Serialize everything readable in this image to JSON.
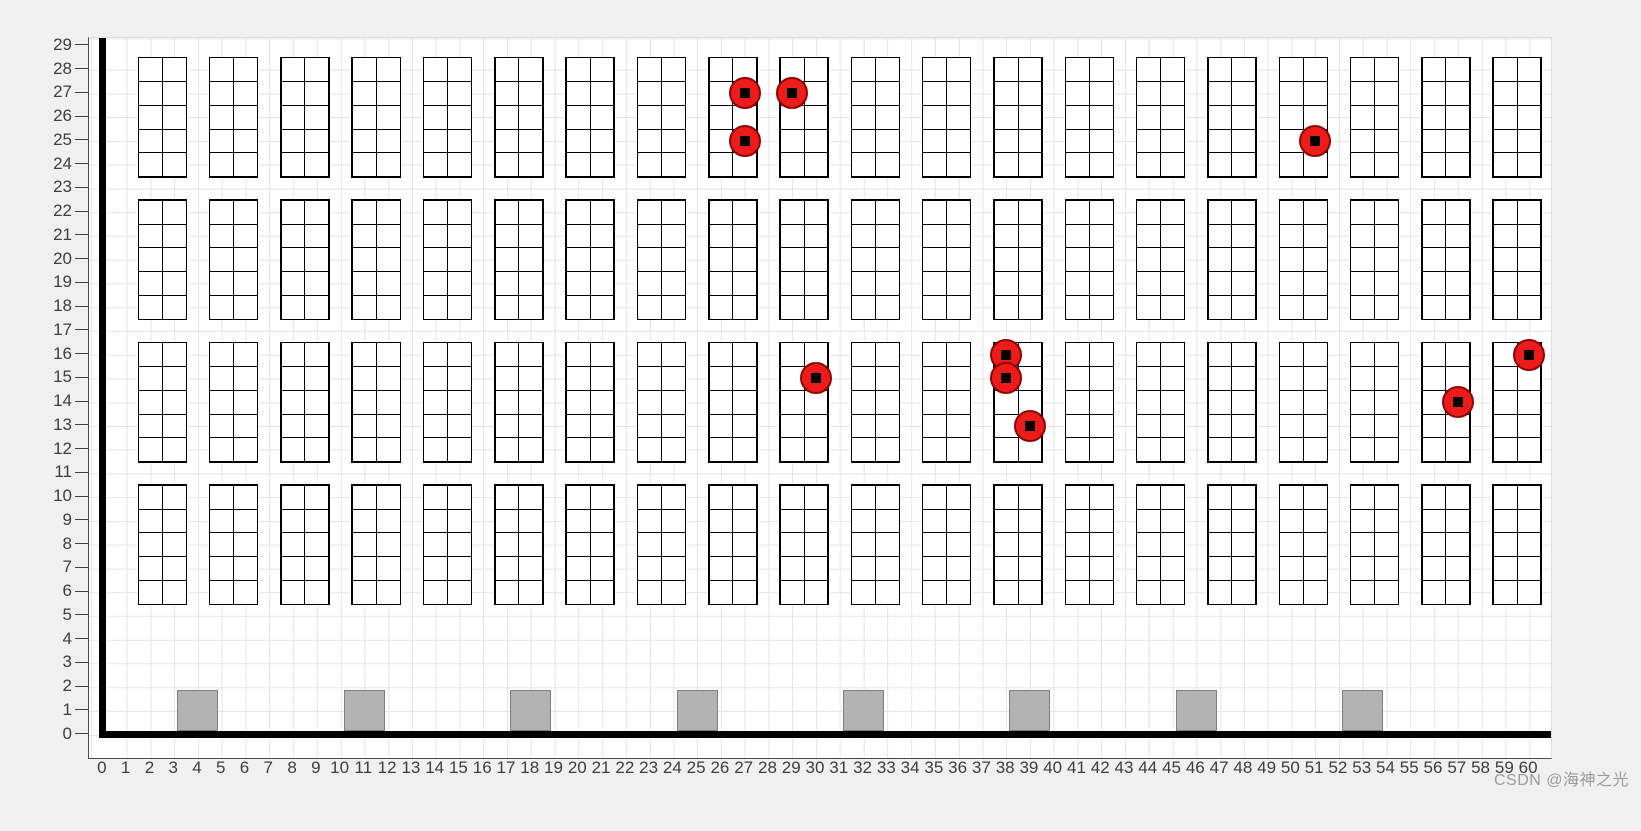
{
  "watermark": {
    "text": "CSDN @海神之光",
    "color": "#9b9b9b"
  },
  "chart_data": {
    "type": "scatter",
    "title": "",
    "xlabel": "",
    "ylabel": "",
    "xlim": [
      -0.6,
      60.9
    ],
    "ylim": [
      -1.0,
      29.3
    ],
    "grid": true,
    "x_ticks": [
      0,
      1,
      2,
      3,
      4,
      5,
      6,
      7,
      8,
      9,
      10,
      11,
      12,
      13,
      14,
      15,
      16,
      17,
      18,
      19,
      20,
      21,
      22,
      23,
      24,
      25,
      26,
      27,
      28,
      29,
      30,
      31,
      32,
      33,
      34,
      35,
      36,
      37,
      38,
      39,
      40,
      41,
      42,
      43,
      44,
      45,
      46,
      47,
      48,
      49,
      50,
      51,
      52,
      53,
      54,
      55,
      56,
      57,
      58,
      59,
      60
    ],
    "y_ticks": [
      0,
      1,
      2,
      3,
      4,
      5,
      6,
      7,
      8,
      9,
      10,
      11,
      12,
      13,
      14,
      15,
      16,
      17,
      18,
      19,
      20,
      21,
      22,
      23,
      24,
      25,
      26,
      27,
      28,
      29
    ],
    "walls": {
      "vertical_at_x": 0,
      "horizontal_at_y": 0,
      "color": "#000000"
    },
    "racks": {
      "count_per_row": 20,
      "first_left_x": 1.5,
      "pitch_x": 3,
      "width_units": 2,
      "height_units": 5,
      "cell_cols": 2,
      "cell_rows": 5,
      "row_y_bottoms": [
        23.5,
        17.5,
        11.5,
        5.5
      ],
      "line_color": "#000000",
      "fill": "#ffffff"
    },
    "stations": {
      "centers_x": [
        4,
        11,
        18,
        25,
        32,
        39,
        46,
        53
      ],
      "bottom_y": 0,
      "size_units": 1.64,
      "fill": "#b3b3b3",
      "border": "#7f7f7f"
    },
    "occupied_slots": {
      "marker": "red-circle-with-black-square-center",
      "fill": "#ee1b1b",
      "edge": "#8c0606",
      "points": [
        {
          "x": 27,
          "y": 27
        },
        {
          "x": 29,
          "y": 27
        },
        {
          "x": 27,
          "y": 25
        },
        {
          "x": 51,
          "y": 25
        },
        {
          "x": 30,
          "y": 15
        },
        {
          "x": 38,
          "y": 16
        },
        {
          "x": 38,
          "y": 15
        },
        {
          "x": 39,
          "y": 13
        },
        {
          "x": 57,
          "y": 14
        },
        {
          "x": 60,
          "y": 16
        }
      ]
    }
  }
}
